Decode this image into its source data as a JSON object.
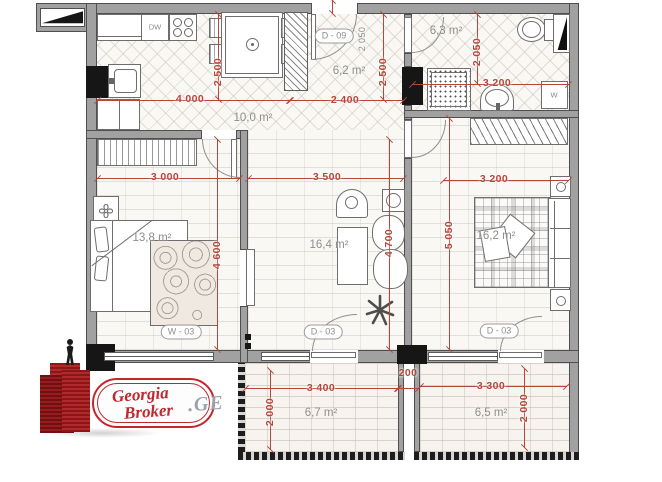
{
  "colors": {
    "dimension_red": "#b2473b",
    "label_gray": "#8c8c8c",
    "wall_gray": "#a1a1a1",
    "column_black": "#161616",
    "logo_red": "#c1272d",
    "tld_gray": "#9aa2ab"
  },
  "rooms": {
    "kitchen": {
      "area": "10,0 m²"
    },
    "hallway": {
      "area": "6,2 m²"
    },
    "bathroom": {
      "area": "6,3 m²"
    },
    "bedroom": {
      "area": "13,8 m²"
    },
    "living_middle": {
      "area": "16,4 m²"
    },
    "living_right": {
      "area": "16,2 m²"
    },
    "balcony_left": {
      "area": "6,7 m²"
    },
    "balcony_right": {
      "area": "6,5 m²"
    }
  },
  "dims": {
    "kitchen_w": "4 000",
    "kitchen_h": "2 500",
    "hall_w": "2 400",
    "hall_h": "2 500",
    "entry_side": "2 050",
    "bath_w": "3 200",
    "bath_h": "2 050",
    "bedroom_w": "3 000",
    "bedroom_h": "4 600",
    "middle_w": "3 500",
    "middle_h": "4 700",
    "right_w": "3 200",
    "right_h": "5 050",
    "balcony_left_w": "3 400",
    "balcony_left_h": "2 000",
    "balcony_gap": "200",
    "balcony_right_w": "3 300",
    "balcony_right_h": "2 000"
  },
  "tags": {
    "entry_door": "D - 09",
    "middle_balcony_door": "D - 03",
    "right_balcony_door": "D - 03",
    "bedroom_window": "W - 03"
  },
  "appliances": {
    "dishwasher": "DW",
    "washer": "W"
  },
  "logo": {
    "word1": "Georgia",
    "word2": "Broker",
    "tld": ".GE"
  }
}
